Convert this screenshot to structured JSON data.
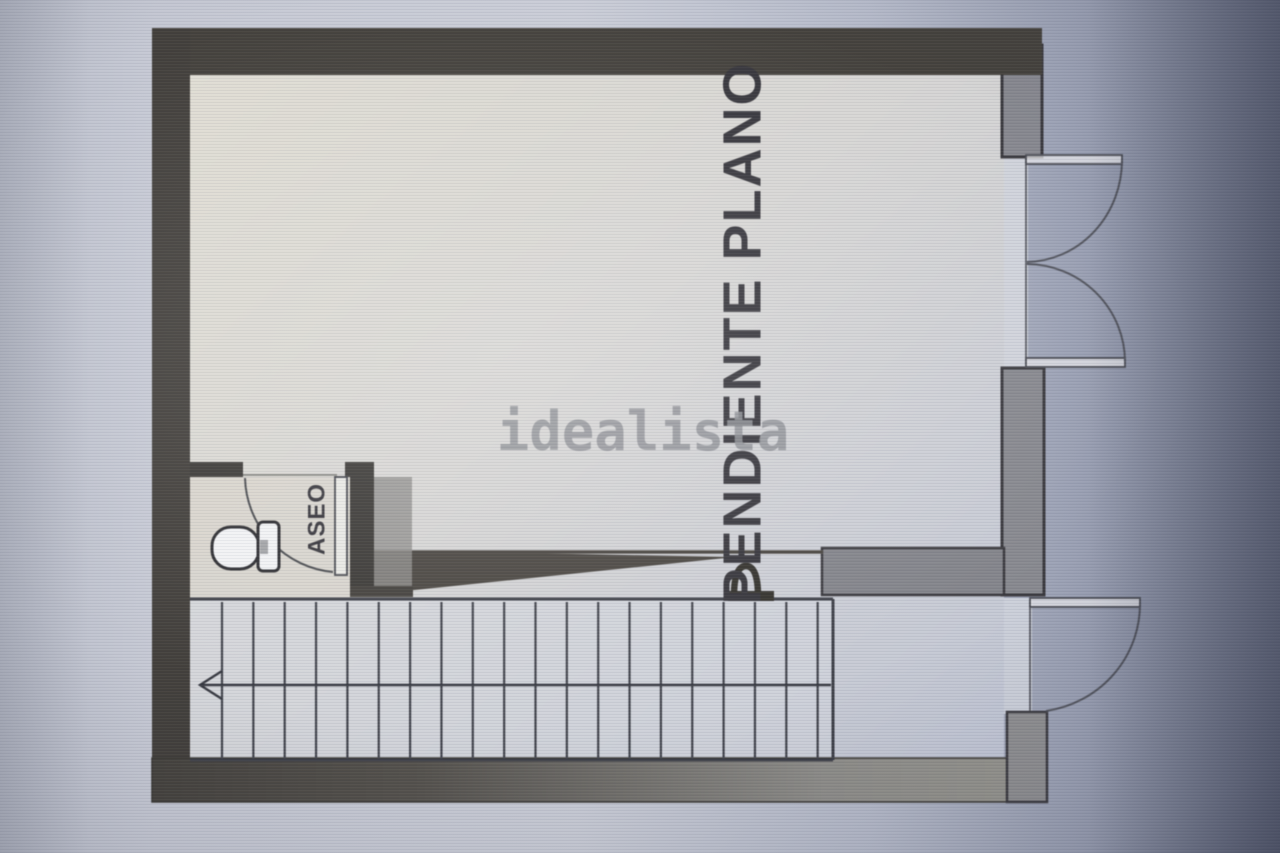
{
  "watermark": {
    "text": "idealista",
    "color": "#8f9196"
  },
  "plan": {
    "area_label": "PENDIENTE PLANO",
    "bathroom_label": "ASEO",
    "stairs": {
      "tread_count": 20,
      "arrow_direction": "left"
    },
    "doors": [
      {
        "id": "entrance-double-door",
        "type": "double-swing-right"
      },
      {
        "id": "lower-single-door",
        "type": "single-swing-right"
      },
      {
        "id": "bathroom-door",
        "type": "single-swing-in"
      }
    ],
    "fixtures": [
      {
        "id": "toilet",
        "room": "ASEO"
      }
    ],
    "colors": {
      "wall_dark": "#45423d",
      "wall_gray": "#87888f",
      "floor_warm": "#dedbd2",
      "floor_cool": "#c3c8d5",
      "line": "#42444c",
      "label_text": "#37363c",
      "background": "#c6c9d4"
    }
  }
}
